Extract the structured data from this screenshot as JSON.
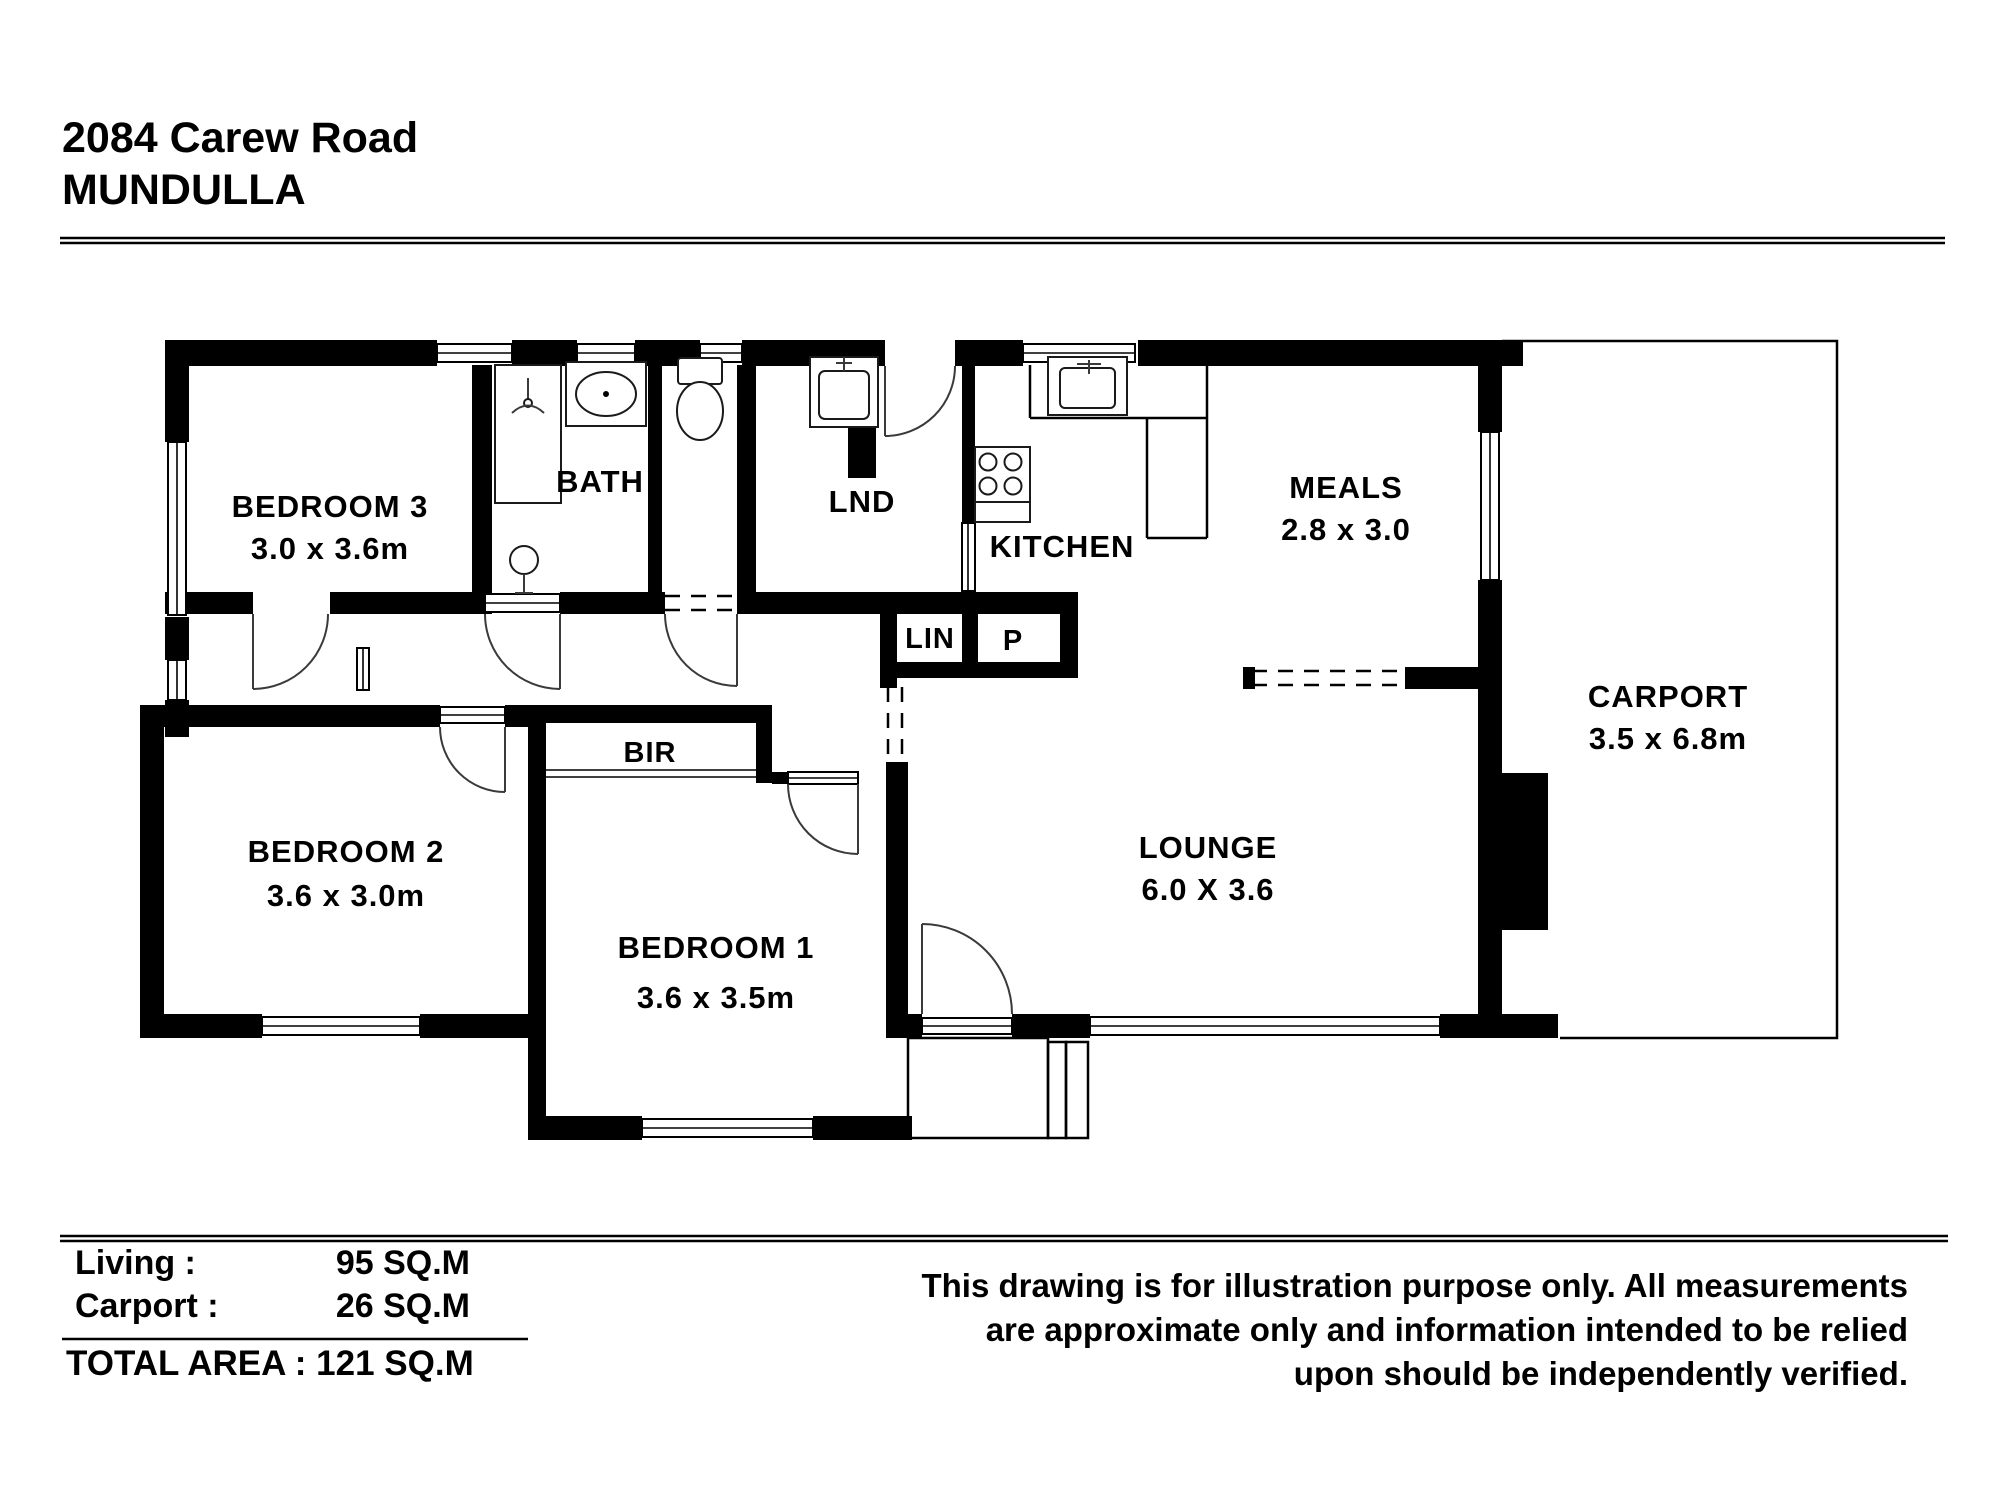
{
  "header": {
    "address_line1": "2084 Carew Road",
    "address_line2": "MUNDULLA"
  },
  "rooms": {
    "bedroom3": {
      "label": "BEDROOM 3",
      "dims": "3.0 x 3.6m"
    },
    "bath": {
      "label": "BATH"
    },
    "lnd": {
      "label": "LND"
    },
    "kitchen": {
      "label": "KITCHEN"
    },
    "meals": {
      "label": "MEALS",
      "dims": "2.8 x 3.0"
    },
    "lin": {
      "label": "LIN"
    },
    "pantry": {
      "label": "P"
    },
    "carport": {
      "label": "CARPORT",
      "dims": "3.5 x 6.8m"
    },
    "bir": {
      "label": "BIR"
    },
    "bedroom2": {
      "label": "BEDROOM 2",
      "dims": "3.6 x 3.0m"
    },
    "bedroom1": {
      "label": "BEDROOM 1",
      "dims": "3.6 x 3.5m"
    },
    "lounge": {
      "label": "LOUNGE",
      "dims": "6.0 X 3.6"
    }
  },
  "areas": {
    "living_label": "Living :",
    "living_value": "95 SQ.M",
    "carport_label": "Carport :",
    "carport_value": "26 SQ.M",
    "total": "TOTAL AREA : 121 SQ.M"
  },
  "disclaimer": {
    "line1": "This drawing is for illustration purpose only. All measurements",
    "line2": "are approximate only and information intended to be relied",
    "line3": "upon should be independently verified."
  },
  "colors": {
    "wall": "#000000",
    "background": "#ffffff",
    "door_arc": "#3a3a3a"
  }
}
